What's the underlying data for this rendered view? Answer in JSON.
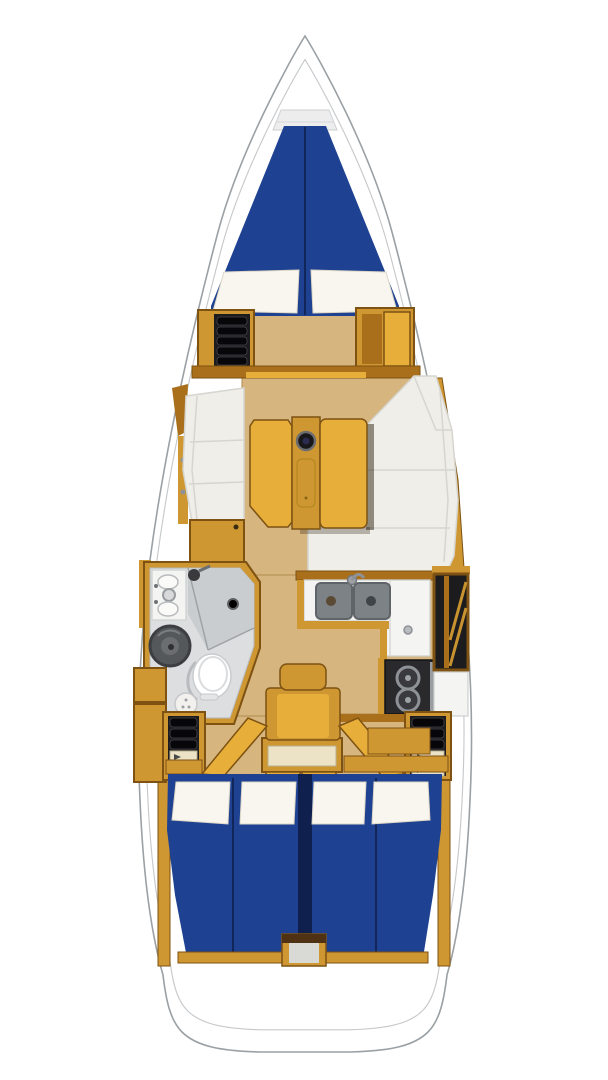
{
  "diagram": {
    "kind": "sailboat-interior-floorplan",
    "view": "top-down",
    "orientation": "bow-up"
  },
  "palette": {
    "hull": "#ffffff",
    "outline": "#9aa0a4",
    "inner_line": "#c6c9cc",
    "berth_blue": "#1e4191",
    "berth_seam": "#13265a",
    "pillow": "#f8f6ef",
    "wood": "#cf9732",
    "wood_bright": "#e7ae3a",
    "wood_dark": "#a96f1b",
    "wood_frame": "#7d5212",
    "floor": "#d6b57e",
    "cushion": "#efeee9",
    "cushion_border": "#d6d5d0",
    "gray_floor": "#dcdedf",
    "shower": "#c9cdd0",
    "counter": "#f4f4f2",
    "sink": "#7d8287",
    "stove": "#2a2a2d",
    "dark_unit": "#1c1c1f",
    "cream": "#ece3c6"
  },
  "areas": {
    "bow": {
      "fixtures": [
        "anchor-locker"
      ]
    },
    "forward_cabin": {
      "fixtures": [
        "v-berth",
        "pillow-port",
        "pillow-starboard",
        "shelf-unit",
        "wardrobe"
      ]
    },
    "salon": {
      "fixtures": [
        "port-settee",
        "storage-cabinet",
        "starboard-settee",
        "folding-table",
        "cup-holder",
        "table-tray"
      ]
    },
    "head": {
      "fixtures": [
        "vanity-sink",
        "shower",
        "shower-head",
        "shower-drain",
        "round-basin",
        "toilet",
        "stool"
      ]
    },
    "galley": {
      "fixtures": [
        "countertop",
        "double-sink",
        "faucet",
        "two-burner-stove",
        "pantry-shelves",
        "refrigerator"
      ]
    },
    "nav_station": {
      "fixtures": [
        "seat",
        "desk",
        "lockers"
      ]
    },
    "aft_cabin_port": {
      "fixtures": [
        "double-berth",
        "pillow",
        "pillow",
        "shelf-unit",
        "open-door"
      ]
    },
    "aft_cabin_starboard": {
      "fixtures": [
        "double-berth",
        "pillow",
        "pillow",
        "shelf-unit",
        "open-door"
      ]
    },
    "stern": {
      "fixtures": [
        "companionway-box",
        "transom"
      ]
    }
  }
}
